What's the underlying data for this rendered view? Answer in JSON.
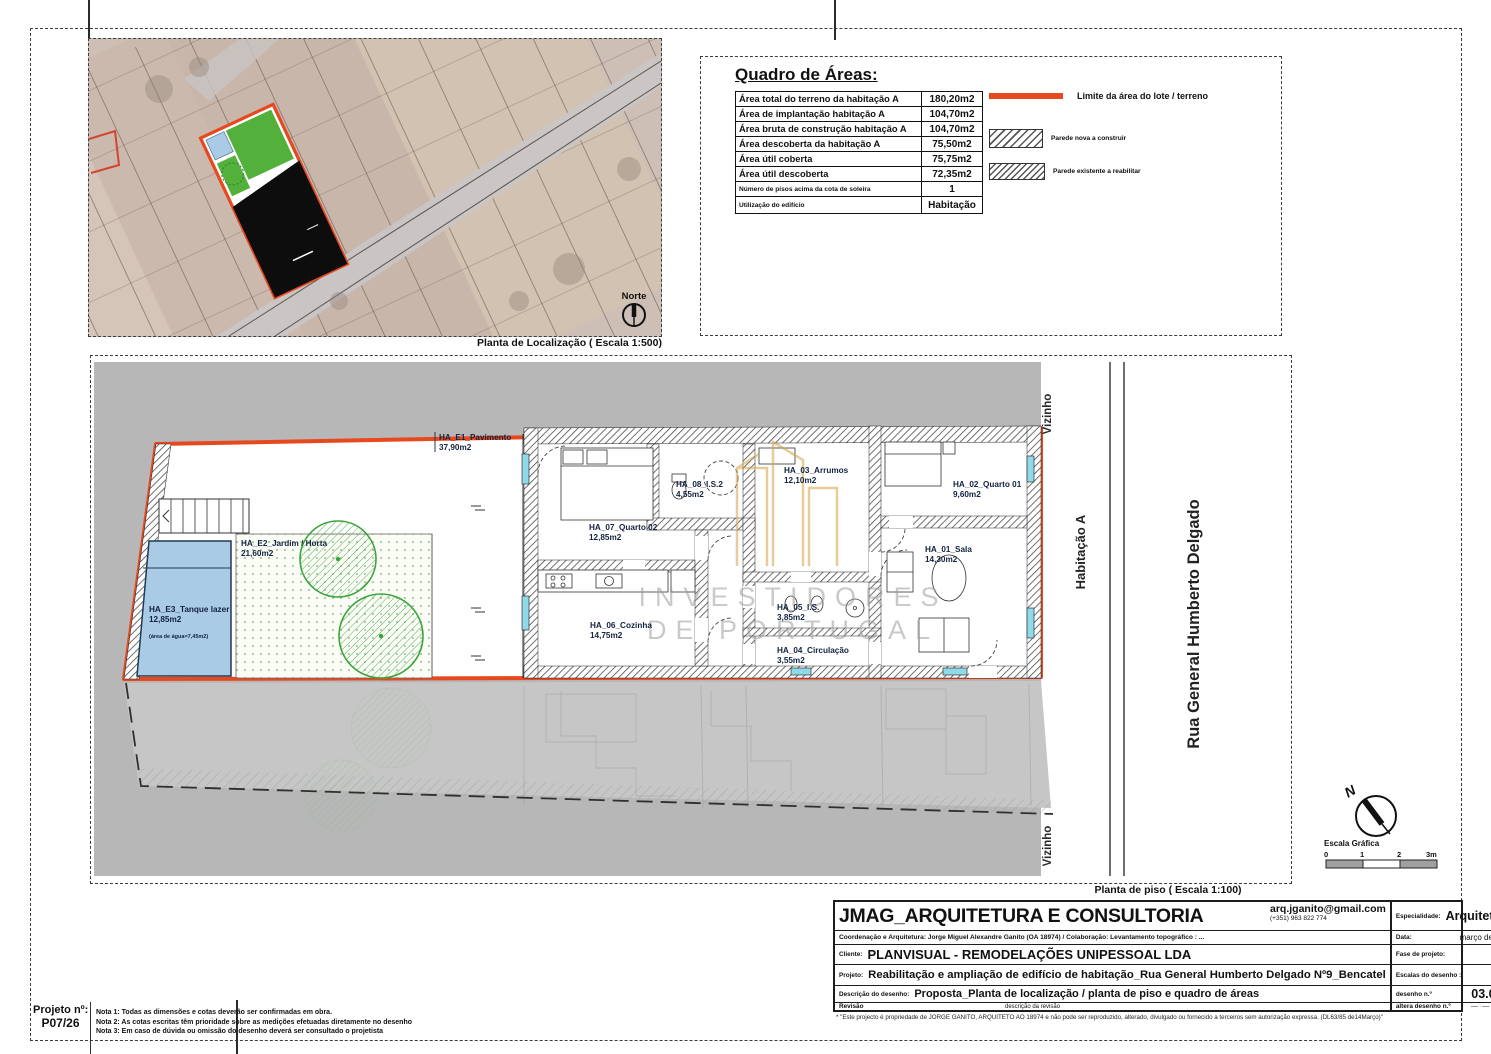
{
  "location_plan": {
    "caption": "Planta de Localização ( Escala 1:500)",
    "north_label": "Norte"
  },
  "areas_table": {
    "title": "Quadro de Áreas:",
    "rows": [
      {
        "label": "Área total do terreno da habitação A",
        "value": "180,20m2"
      },
      {
        "label": "Área de implantação habitação A",
        "value": "104,70m2"
      },
      {
        "label": "Área bruta de construção habitação A",
        "value": "104,70m2"
      },
      {
        "label": "Área descoberta da habitação A",
        "value": "75,50m2"
      },
      {
        "label": "Área útil coberta",
        "value": "75,75m2"
      },
      {
        "label": "Área útil descoberta",
        "value": "72,35m2"
      },
      {
        "label": "Número de pisos acima da cota de soleira",
        "value": "1"
      },
      {
        "label": "Utilização do edifício",
        "value": "Habitação"
      }
    ]
  },
  "legend": {
    "items": [
      {
        "label": "Limite da área do lote / terreno",
        "swatch": "red-line"
      },
      {
        "label": "Parede nova a construir",
        "swatch": "hatch-new"
      },
      {
        "label": "Parede existente a reabilitar",
        "swatch": "hatch-existing"
      }
    ]
  },
  "floor_plan": {
    "caption": "Planta de piso ( Escala 1:100)",
    "context": {
      "neighbor_top": "Vizinho",
      "neighbor_bottom": "Vizinho",
      "unit": "Habitação A",
      "street": "Rua General Humberto Delgado"
    },
    "rooms": [
      {
        "name": "HA_E1_Pavimento",
        "area": "37,90m2"
      },
      {
        "name": "HA_E2_Jardim / Horta",
        "area": "21,60m2"
      },
      {
        "name": "HA_E3_Tanque lazer",
        "area": "12,85m2",
        "note": "(área de água=7,45m2)"
      },
      {
        "name": "HA_07_Quarto 02",
        "area": "12,85m2"
      },
      {
        "name": "HA_08_I.S.2",
        "area": "4,55m2"
      },
      {
        "name": "HA_03_Arrumos",
        "area": "12,10m2"
      },
      {
        "name": "HA_02_Quarto 01",
        "area": "9,60m2"
      },
      {
        "name": "HA_01_Sala",
        "area": "14,30m2"
      },
      {
        "name": "HA_06_Cozinha",
        "area": "14,75m2"
      },
      {
        "name": "HA_05_I.S.",
        "area": "3,85m2"
      },
      {
        "name": "HA_04_Circulação",
        "area": "3,55m2"
      }
    ],
    "watermark": {
      "line1": "INVESTIDORES",
      "line2": "DE PORTUGAL"
    },
    "north_letter": "N",
    "scale_bar": {
      "title": "Escala Gráfica",
      "ticks": [
        "0",
        "1",
        "2",
        "3m"
      ]
    }
  },
  "title_block": {
    "company": "JMAG_ARQUITETURA E CONSULTORIA",
    "email": "arq.jganito@gmail.com",
    "phone": "(+351) 963 822 774",
    "coordination": "Coordenação e Arquitetura: Jorge Miguel Alexandre Ganito (OA 18974)  / Colaboração: Levantamento topográfico : ...",
    "client_label": "Cliente:",
    "client": "PLANVISUAL - REMODELAÇÕES UNIPESSOAL LDA",
    "project_label": "Projeto:",
    "project": "Reabilitação e ampliação de edifício de habitação_Rua General Humberto Delgado Nº9_Bencatel",
    "description_label": "Descrição do desenho:",
    "description": "Proposta_Planta de localização / planta de piso  e quadro de áreas",
    "revision_label": "Revisão",
    "revision_desc": "descrição da revisão",
    "meta": [
      {
        "label": "Especialidade:",
        "value": "Arquitetura"
      },
      {
        "label": "Data:",
        "value": "março de 2026"
      },
      {
        "label": "Fase de projeto:",
        "value": "EP"
      },
      {
        "label": "Escalas do desenho :",
        "value": "1:100"
      },
      {
        "label": "desenho n.º",
        "value": "03.02.1"
      },
      {
        "label": "altera desenho n.º",
        "value": "—·—·—·—"
      }
    ],
    "footnote": "* \"Este projecto é propriedade de JORGE GANITO, ARQUITETO  AO 18974 e não pode ser reproduzido, alterado, divulgado ou fornecido a terceiros sem autorização expressa. (DL63/85 de14Março)\""
  },
  "project_box": {
    "label": "Projeto nº:",
    "value": "P07/26"
  },
  "notes": [
    "Nota 1: Todas as dimensões e cotas deverão ser confirmadas em obra.",
    "Nota 2: As  cotas escritas têm prioridade sobre  as medições efetuadas diretamente no desenho",
    "Nota 3: Em caso de dúvida ou omissão do desenho deverá ser consultado o projetista"
  ],
  "colors": {
    "lot_boundary": "#e8481e",
    "neighbor_gray": "#b7b7b7",
    "pool_blue": "#a9cbe6",
    "tree_green": "#3aa53a",
    "watermark_gold": "#d2a545"
  }
}
